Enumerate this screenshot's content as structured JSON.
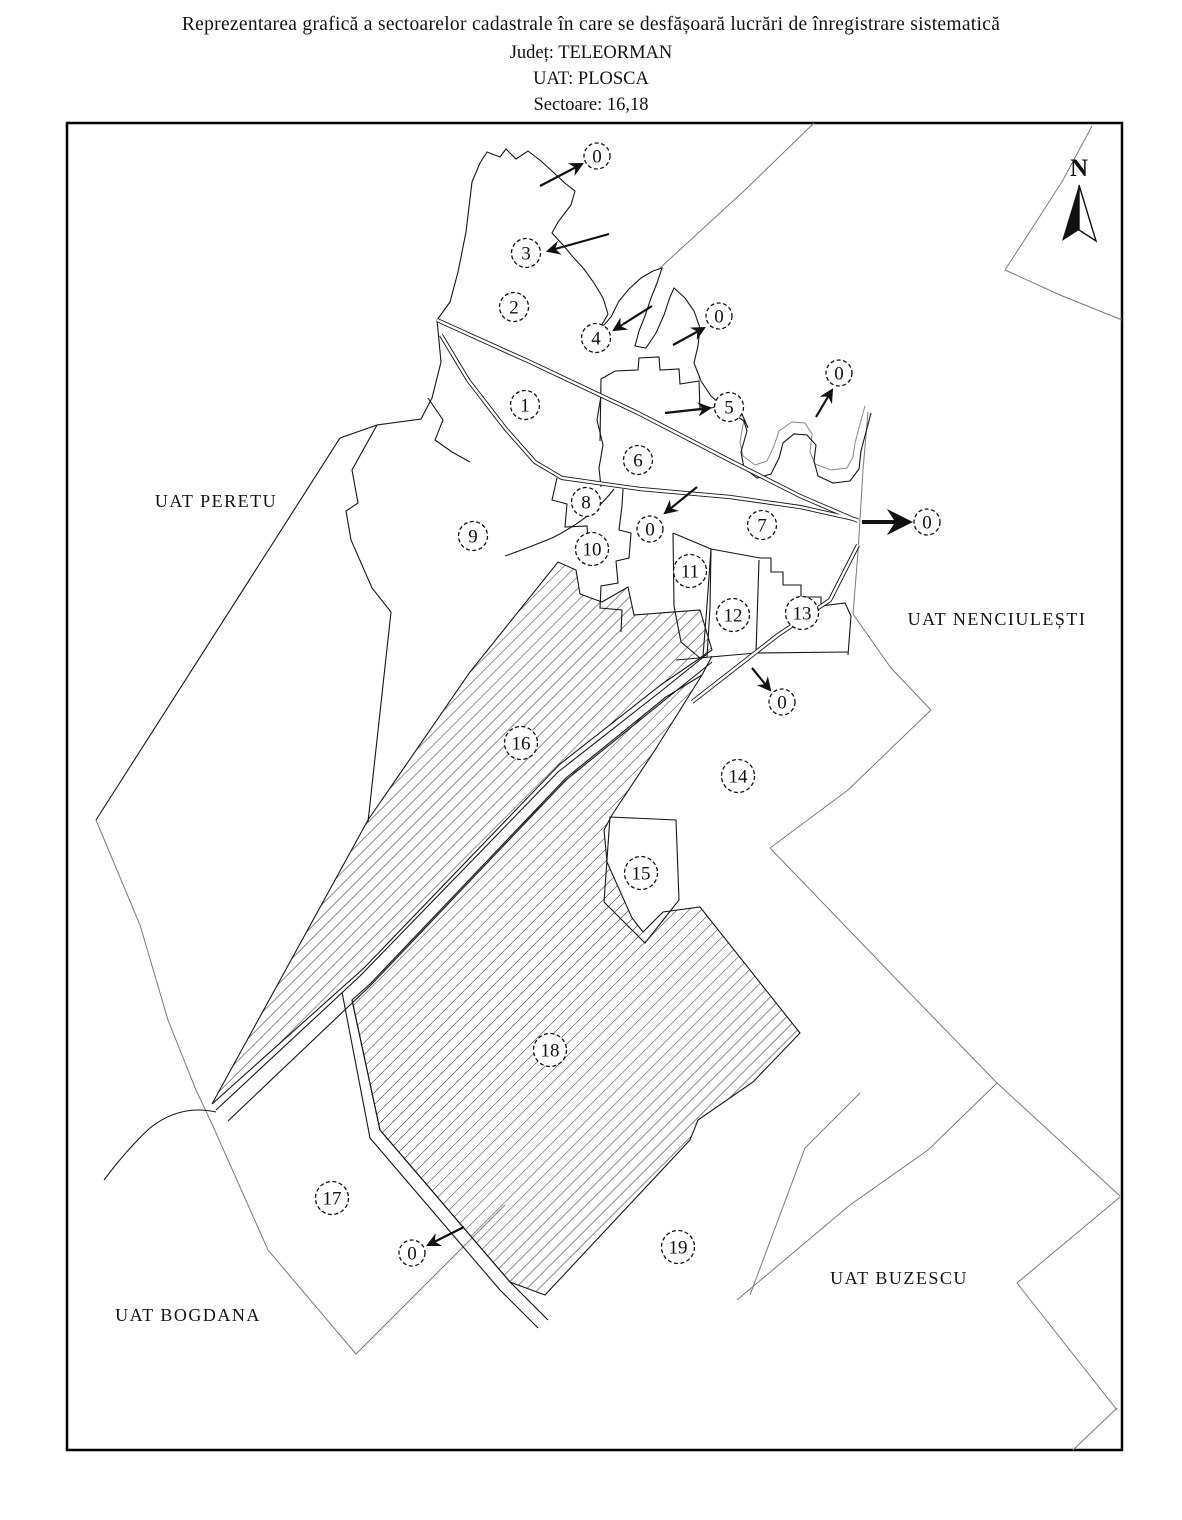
{
  "title": {
    "line1": "Reprezentarea grafică a sectoarelor cadastrale în care se desfășoară lucrări de înregistrare sistematică",
    "line2": "Județ: TELEORMAN",
    "line3": "UAT: PLOSCA",
    "line4": "Sectoare: 16,18"
  },
  "map": {
    "north_indicator": {
      "label": "N"
    },
    "hatched_sectors": [
      "16",
      "18"
    ],
    "colors": {
      "line": "#161616",
      "neighbor_line": "#7a7a7a",
      "river_line": "#8a8a8a",
      "background": "#ffffff"
    },
    "uat_labels": [
      {
        "text": "UAT PERETU",
        "x": 216,
        "y": 507
      },
      {
        "text": "UAT NENCIULEȘTI",
        "x": 997,
        "y": 625
      },
      {
        "text": "UAT BOGDANA",
        "x": 188,
        "y": 1321
      },
      {
        "text": "UAT BUZESCU",
        "x": 899,
        "y": 1284
      }
    ],
    "sector_markers": [
      {
        "label": "1",
        "x": 525,
        "y": 405
      },
      {
        "label": "2",
        "x": 514,
        "y": 307
      },
      {
        "label": "3",
        "x": 526,
        "y": 253
      },
      {
        "label": "4",
        "x": 596,
        "y": 338
      },
      {
        "label": "5",
        "x": 729,
        "y": 407
      },
      {
        "label": "6",
        "x": 638,
        "y": 460
      },
      {
        "label": "7",
        "x": 762,
        "y": 525
      },
      {
        "label": "8",
        "x": 586,
        "y": 502
      },
      {
        "label": "9",
        "x": 473,
        "y": 536
      },
      {
        "label": "10",
        "x": 592,
        "y": 549
      },
      {
        "label": "11",
        "x": 690,
        "y": 571
      },
      {
        "label": "12",
        "x": 733,
        "y": 615
      },
      {
        "label": "13",
        "x": 802,
        "y": 613
      },
      {
        "label": "14",
        "x": 738,
        "y": 776
      },
      {
        "label": "15",
        "x": 641,
        "y": 873
      },
      {
        "label": "16",
        "x": 521,
        "y": 743
      },
      {
        "label": "17",
        "x": 332,
        "y": 1198
      },
      {
        "label": "18",
        "x": 550,
        "y": 1050
      },
      {
        "label": "19",
        "x": 678,
        "y": 1247
      },
      {
        "label": "0",
        "x": 597,
        "y": 156
      },
      {
        "label": "0",
        "x": 719,
        "y": 316
      },
      {
        "label": "0",
        "x": 839,
        "y": 373
      },
      {
        "label": "0",
        "x": 650,
        "y": 529
      },
      {
        "label": "0",
        "x": 927,
        "y": 522
      },
      {
        "label": "0",
        "x": 782,
        "y": 702
      },
      {
        "label": "0",
        "x": 412,
        "y": 1253
      }
    ],
    "arrows": [
      {
        "x1": 540,
        "y1": 186,
        "x2": 582,
        "y2": 164,
        "thick": false
      },
      {
        "x1": 609,
        "y1": 234,
        "x2": 548,
        "y2": 251,
        "thick": false
      },
      {
        "x1": 652,
        "y1": 306,
        "x2": 614,
        "y2": 330,
        "thick": false
      },
      {
        "x1": 673,
        "y1": 345,
        "x2": 704,
        "y2": 328,
        "thick": false
      },
      {
        "x1": 665,
        "y1": 413,
        "x2": 710,
        "y2": 408,
        "thick": false
      },
      {
        "x1": 816,
        "y1": 417,
        "x2": 832,
        "y2": 390,
        "thick": false
      },
      {
        "x1": 697,
        "y1": 487,
        "x2": 665,
        "y2": 513,
        "thick": false
      },
      {
        "x1": 862,
        "y1": 522,
        "x2": 909,
        "y2": 522,
        "thick": true
      },
      {
        "x1": 752,
        "y1": 668,
        "x2": 770,
        "y2": 690,
        "thick": false
      },
      {
        "x1": 464,
        "y1": 1227,
        "x2": 428,
        "y2": 1245,
        "thick": false
      }
    ]
  }
}
